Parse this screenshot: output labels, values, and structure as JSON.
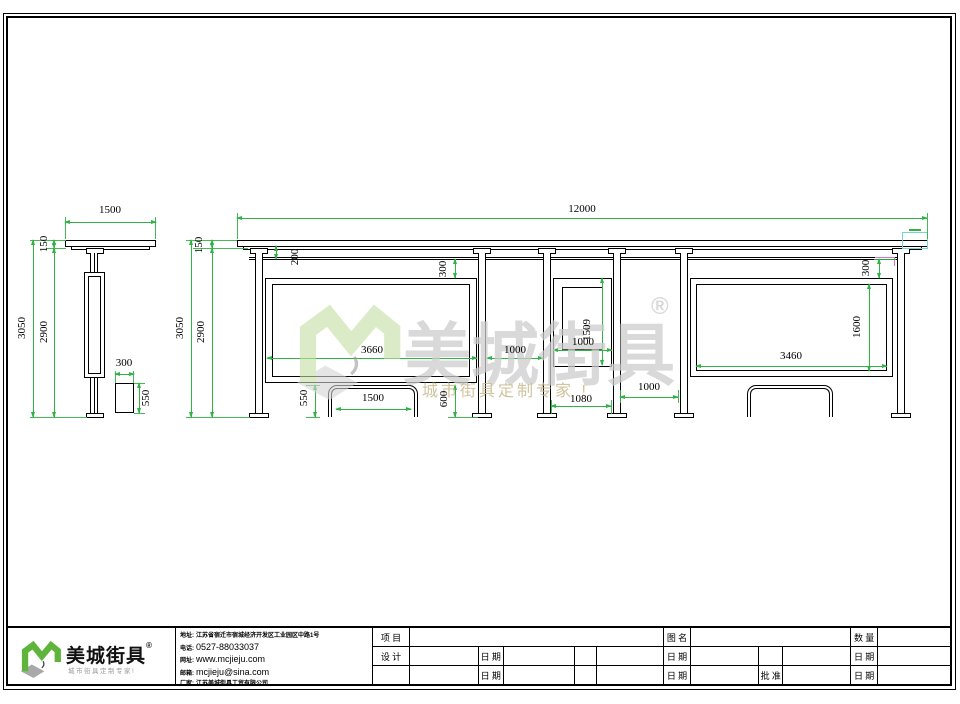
{
  "watermark": {
    "brand": "美城街具",
    "registered": "®",
    "tagline": "城市街具定制专家 !"
  },
  "logo": {
    "brand": "美城街具",
    "registered": "®",
    "tagline": "城市街具定制专家!"
  },
  "contact": {
    "address_label": "地址:",
    "address_value": "江苏省宿迁市宿城经济开发区工业园区中路1号",
    "phone_label": "电话:",
    "phone_value": "0527-88033037",
    "website_label": "网址:",
    "website_value": "www.mcjieju.com",
    "email_label": "邮箱:",
    "email_value": "mcjieju@sina.com",
    "company_label": "厂家:",
    "company_value": "江苏美城街具工贸有限公司"
  },
  "titleblock": {
    "project_label": "项 目",
    "drawing_name_label": "图 名",
    "quantity_label": "数 量",
    "designer_label": "设 计",
    "date_label": "日 期",
    "approval_label": "批 准"
  },
  "dims": {
    "side_roof_width": "1500",
    "side_roof_thickness": "150",
    "side_total_height": "3050",
    "side_column_height": "2900",
    "side_bin_width": "300",
    "side_bin_height": "550",
    "front_total_width": "12000",
    "front_roof_thickness": "150",
    "front_total_height": "3050",
    "front_column_height": "2900",
    "front_roof_to_rail": "200",
    "front_rail_to_panel_left": "300",
    "front_panel1_width": "3660",
    "front_gap_col2_col3": "1000",
    "front_panel2_width": "1000",
    "front_panel2_height": "1509",
    "front_panel2_span": "1080",
    "front_gap_col4_col5": "1000",
    "front_panel3_width": "3460",
    "front_panel3_height": "1600",
    "front_rail_to_panel_right": "300",
    "front_bench_height": "550",
    "front_bench_width": "1500",
    "front_panel_bottom_clearance": "600"
  },
  "colors": {
    "dimension_green": "#2fb344",
    "highlight_cyan": "#7ad4d4",
    "highlight_magenta": "#e070c8",
    "brand_green": "#6cbe45",
    "watermark_gray": "#cdcdcd"
  }
}
